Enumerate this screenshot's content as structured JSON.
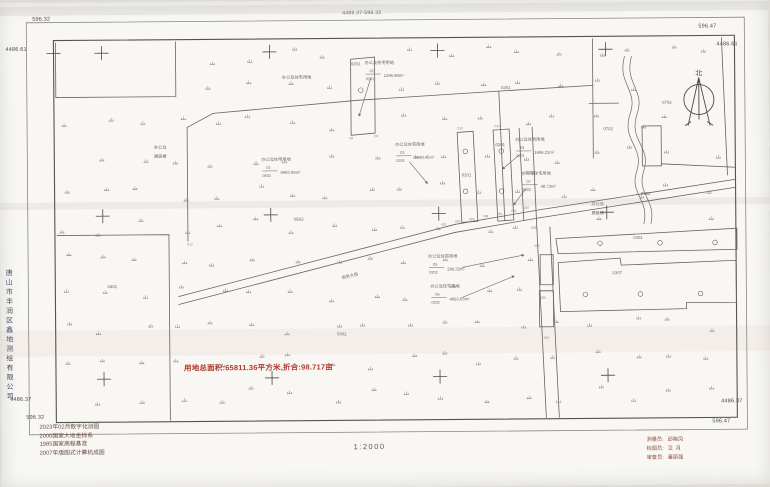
{
  "sheet": {
    "number": "4486.37-596.32",
    "scale": "1:2000"
  },
  "corner_coords": {
    "top_left_x": "596.32",
    "top_left_y": "4486.61",
    "top_right_x": "596.47",
    "top_right_y": "4486.61",
    "bottom_left_y": "4486.37",
    "bottom_left_x": "596.32",
    "bottom_right_y": "4486.37",
    "bottom_right_x": "596.47"
  },
  "side_company": "唐山市丰润区鑫地测绘有限公司",
  "summary_text": "用地总面积:65811.36平方米,折合:98.717亩",
  "notes": [
    "2023年02月数字化测图",
    "2000国家大地坐标系",
    "1985国家高程基准",
    "2007年版图式计算机成图"
  ],
  "credits": [
    {
      "role": "测量员:",
      "name": "邱晓凤"
    },
    {
      "role": "检图员:",
      "name": "卫  月"
    },
    {
      "role": "审查员:",
      "name": "董丽强"
    }
  ],
  "colors": {
    "paper": "#f8f7f3",
    "line": "#66645f",
    "frame": "#55534e",
    "red_text": "#b03a2e",
    "note_text": "#6b4a45",
    "credit_text": "#8f4a44"
  },
  "map": {
    "north_label": {
      "t": "北",
      "x": 700,
      "y": 78,
      "s": 7
    },
    "labels": [
      {
        "t": "0201",
        "x": 357,
        "y": 65,
        "s": 4.3
      },
      {
        "t": "0201",
        "x": 507,
        "y": 90,
        "s": 4.3
      },
      {
        "t": "0201",
        "x": 467,
        "y": 177,
        "s": 4.3
      },
      {
        "t": "0201",
        "x": 501,
        "y": 147,
        "s": 4.3
      },
      {
        "t": "0202",
        "x": 531,
        "y": 175,
        "s": 4.3
      },
      {
        "t": "0502",
        "x": 299,
        "y": 220,
        "s": 4.3
      },
      {
        "t": "0401",
        "x": 112,
        "y": 286,
        "s": 4.3
      },
      {
        "t": "0302",
        "x": 341,
        "y": 335,
        "s": 4.3
      },
      {
        "t": "0301",
        "x": 638,
        "y": 241,
        "s": 4.3
      },
      {
        "t": "0307",
        "x": 617,
        "y": 276,
        "s": 4.3
      },
      {
        "t": "0702",
        "x": 668,
        "y": 106,
        "s": 4.3
      },
      {
        "t": "0702",
        "x": 609,
        "y": 132,
        "s": 4.3
      },
      {
        "t": "0702",
        "x": 646,
        "y": 197,
        "s": 4.3
      },
      {
        "t": "办公及住宅用地",
        "x": 298,
        "y": 78,
        "s": 4.2
      },
      {
        "t": "办公及",
        "x": 161,
        "y": 147,
        "s": 4.2
      },
      {
        "t": "居民楼",
        "x": 161,
        "y": 156,
        "s": 4.2
      },
      {
        "t": "办公及",
        "x": 598,
        "y": 207,
        "s": 4.2
      },
      {
        "t": "居民楼",
        "x": 598,
        "y": 216,
        "s": 4.2
      },
      {
        "t": "商务大街",
        "x": 350,
        "y": 277,
        "s": 4.2,
        "r": -13
      }
    ],
    "annotations": [
      {
        "label": "办公及住宅用地",
        "num": "01",
        "den": "0502",
        "area": "5463.06m²",
        "x": 262,
        "y": 160
      },
      {
        "label": "办公及住宅用地",
        "num": "02",
        "den": "0201",
        "area": "1296.98m²",
        "x": 366,
        "y": 64,
        "leader": [
          372,
          78,
          360,
          116
        ]
      },
      {
        "label": "办公及住宅用地",
        "num": "03",
        "den": "0201",
        "area": "2448.45m²",
        "x": 396,
        "y": 146,
        "leader": [
          410,
          162,
          428,
          184
        ]
      },
      {
        "label": "办公及住宅用地",
        "num": "04",
        "den": "0201",
        "area": "1696.22m²",
        "x": 516,
        "y": 142,
        "leader": [
          520,
          156,
          503,
          170
        ]
      },
      {
        "label": "办公及住宅用地",
        "num": "07",
        "den": "0202",
        "area": "48.73m²",
        "x": 522,
        "y": 176,
        "leader": [
          526,
          190,
          514,
          206
        ]
      },
      {
        "label": "办公及住宅用地",
        "num": "05",
        "den": "0202",
        "area": "296.32m²",
        "x": 428,
        "y": 258,
        "leader": [
          462,
          268,
          524,
          256
        ]
      },
      {
        "label": "办公及住宅用地",
        "num": "06",
        "den": "0202",
        "area": "4863.63m²",
        "x": 430,
        "y": 288,
        "leader": [
          462,
          298,
          514,
          277
        ]
      }
    ],
    "point_labels": [
      {
        "t": "081",
        "x": 444,
        "y": 226
      },
      {
        "t": "082",
        "x": 458,
        "y": 223
      },
      {
        "t": "083",
        "x": 472,
        "y": 221
      },
      {
        "t": "084",
        "x": 486,
        "y": 218
      },
      {
        "t": "085",
        "x": 500,
        "y": 216
      },
      {
        "t": "086",
        "x": 514,
        "y": 213
      },
      {
        "t": "087",
        "x": 527,
        "y": 210
      },
      {
        "t": "088",
        "x": 534,
        "y": 230
      },
      {
        "t": "089",
        "x": 537,
        "y": 248
      },
      {
        "t": "D8",
        "x": 352,
        "y": 139
      },
      {
        "t": "D9",
        "x": 377,
        "y": 137
      },
      {
        "t": "D10",
        "x": 461,
        "y": 130
      },
      {
        "t": "D11",
        "x": 498,
        "y": 128
      },
      {
        "t": "D12",
        "x": 190,
        "y": 244
      },
      {
        "t": "090",
        "x": 543,
        "y": 300
      },
      {
        "t": "091",
        "x": 546,
        "y": 340
      }
    ]
  }
}
